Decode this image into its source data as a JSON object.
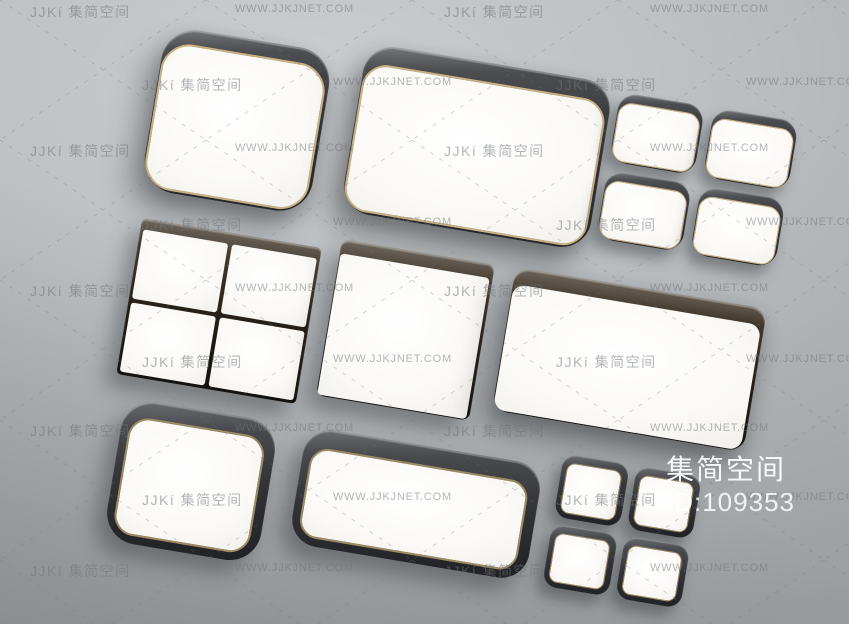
{
  "overlay": {
    "brand": "集简空间",
    "id_label": "ID:109353"
  },
  "watermarks": {
    "brand_text": "JJKí 集简空间",
    "site_text": "WWW.JJKJNET.COM",
    "instances": [
      {
        "type": "brand",
        "x": 30,
        "y": 2
      },
      {
        "type": "site",
        "x": 235,
        "y": 3
      },
      {
        "type": "brand",
        "x": 444,
        "y": 2
      },
      {
        "type": "site",
        "x": 650,
        "y": 3
      },
      {
        "type": "brand",
        "x": 142,
        "y": 75
      },
      {
        "type": "site",
        "x": 333,
        "y": 76
      },
      {
        "type": "brand",
        "x": 556,
        "y": 75
      },
      {
        "type": "site",
        "x": 746,
        "y": 76
      },
      {
        "type": "brand",
        "x": 30,
        "y": 141
      },
      {
        "type": "site",
        "x": 235,
        "y": 142
      },
      {
        "type": "brand",
        "x": 444,
        "y": 141
      },
      {
        "type": "site",
        "x": 650,
        "y": 142
      },
      {
        "type": "brand",
        "x": 142,
        "y": 215
      },
      {
        "type": "site",
        "x": 333,
        "y": 216
      },
      {
        "type": "brand",
        "x": 556,
        "y": 215
      },
      {
        "type": "site",
        "x": 746,
        "y": 216
      },
      {
        "type": "brand",
        "x": 30,
        "y": 281
      },
      {
        "type": "site",
        "x": 235,
        "y": 282
      },
      {
        "type": "brand",
        "x": 444,
        "y": 281
      },
      {
        "type": "site",
        "x": 650,
        "y": 282
      },
      {
        "type": "brand",
        "x": 142,
        "y": 352
      },
      {
        "type": "site",
        "x": 333,
        "y": 353
      },
      {
        "type": "brand",
        "x": 556,
        "y": 352
      },
      {
        "type": "site",
        "x": 746,
        "y": 353
      },
      {
        "type": "brand",
        "x": 30,
        "y": 421
      },
      {
        "type": "site",
        "x": 235,
        "y": 422
      },
      {
        "type": "brand",
        "x": 444,
        "y": 421
      },
      {
        "type": "site",
        "x": 650,
        "y": 422
      },
      {
        "type": "brand",
        "x": 142,
        "y": 490
      },
      {
        "type": "site",
        "x": 333,
        "y": 491
      },
      {
        "type": "brand",
        "x": 556,
        "y": 490
      },
      {
        "type": "site",
        "x": 746,
        "y": 491
      },
      {
        "type": "brand",
        "x": 30,
        "y": 561
      },
      {
        "type": "site",
        "x": 235,
        "y": 562
      },
      {
        "type": "brand",
        "x": 444,
        "y": 561
      },
      {
        "type": "site",
        "x": 650,
        "y": 562
      }
    ]
  },
  "colors": {
    "gold_rim": "#c8b284",
    "pinstripe": "#9c8a64",
    "charcoal_side": "#323337",
    "brown_side": "#241e17",
    "black_frame": "#2a2b2f",
    "lamp_face": "#faf9f6",
    "background_light": "#cbced0",
    "background_dark": "#9b9ea0",
    "watermark_gray": "#70757b",
    "overlay_text": "#ffffff"
  }
}
